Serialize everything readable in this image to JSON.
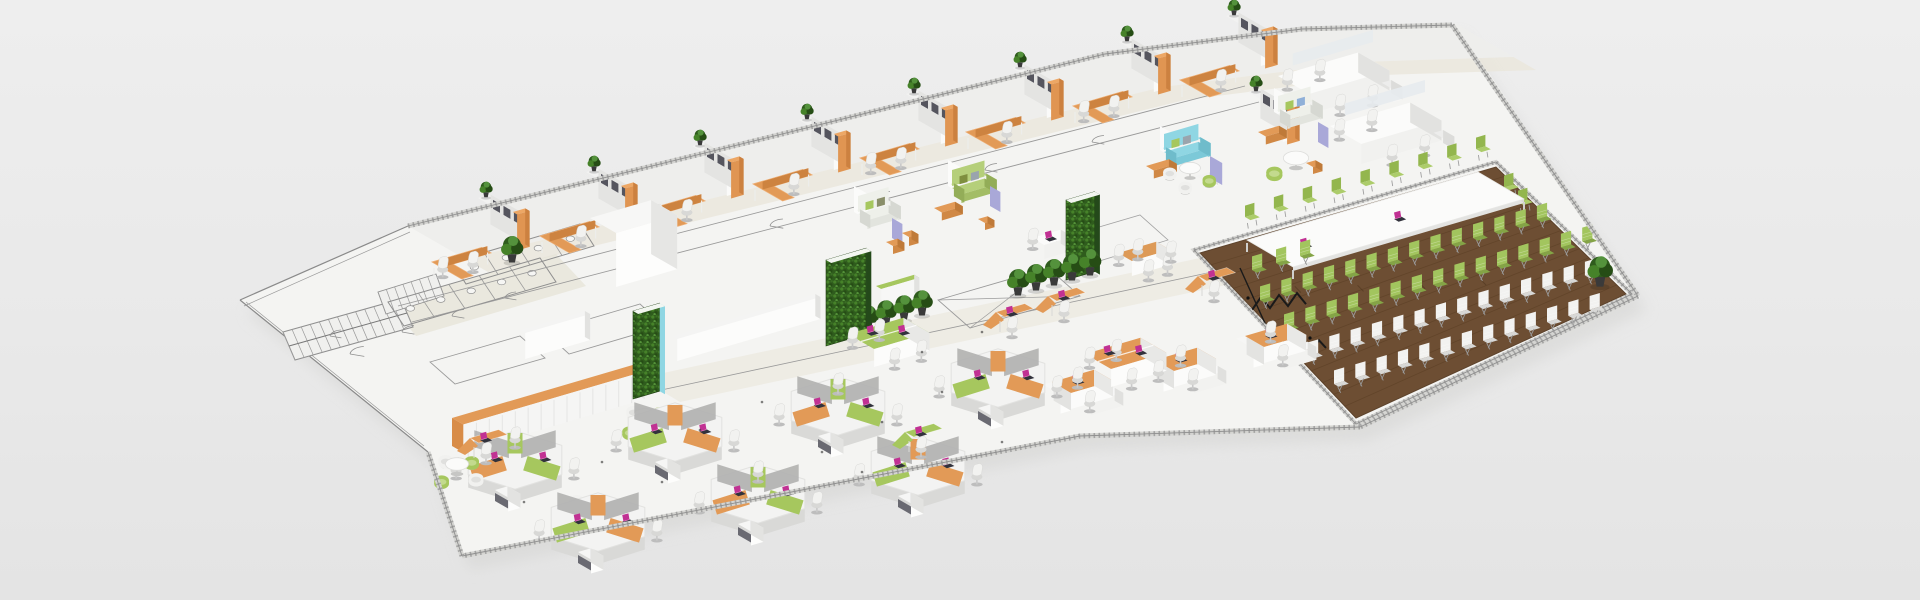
{
  "meta": {
    "title": "Isometric 3D office floor plan render",
    "image_type": "3d-render",
    "visible_text": "none"
  },
  "palette": {
    "background_top": "#eeeeee",
    "background_bottom": "#e4e4e4",
    "floor": "#f4f4f2",
    "floor_band": "#eeeeec",
    "corridor_beige": "#e9e5d9",
    "blueprint_line": "#9a9a9a",
    "blueprint_line_dark": "#7a7a7a",
    "wall_white": "#f7f7f6",
    "wall_shade": "#e3e3e1",
    "furniture_white": "#fbfbfa",
    "orange": "#e29a57",
    "orange_dark": "#cd8340",
    "orange_deep": "#c1762f",
    "green": "#a6c75e",
    "green_dark": "#8fb34a",
    "green_chair": "#a2c55e",
    "green_chair_seat": "#84a446",
    "leaf_dark": "#2f5c1d",
    "leaf_mid": "#468229",
    "wood_floor": "#6d4e33",
    "wood_line": "#55391f",
    "cyan": "#8fd6e3",
    "lavender": "#a9a8d8",
    "chair_white": "#f2f2f0",
    "chair_white_seat": "#d8d8d6",
    "gray_screen": "#bcbcbb",
    "laptop_body": "#32323c",
    "laptop_screen": "#c13193",
    "cable_black": "#1a1a1a"
  },
  "inventory": {
    "private_office_cells": 8,
    "open_bench_clusters": 2,
    "lounge_sofa_sets": 5,
    "green_wall_columns": 3,
    "hex_workstation_clusters": 7,
    "team_tables": {
      "green": 1,
      "orange": 3
    },
    "single_desks_orange": 4,
    "round_lounge_sets": 4,
    "conference": {
      "table": 1,
      "table_chairs_green": 14,
      "audience_rows": [
        {
          "color": "green",
          "chairs": 14
        },
        {
          "color": "green",
          "chairs": 15
        },
        {
          "color": "white",
          "chairs": 14
        },
        {
          "color": "white",
          "chairs": 13
        }
      ]
    },
    "potted_plants": 13,
    "laptops": 22,
    "blueprint": {
      "stair_flights": 2,
      "restroom_stalls": 9,
      "door_arcs": 10
    }
  }
}
